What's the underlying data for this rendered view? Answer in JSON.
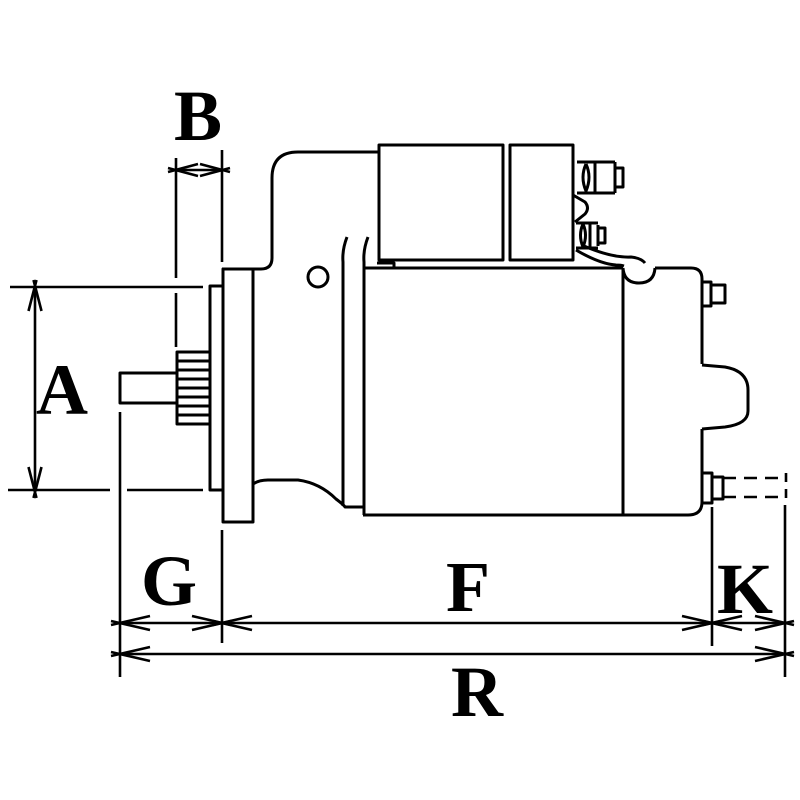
{
  "figure": {
    "colors": {
      "background": "#ffffff",
      "line": "#000000"
    },
    "dimensions": {
      "a": "A",
      "b": "B",
      "g": "G",
      "f": "F",
      "k": "K",
      "r": "R"
    }
  }
}
